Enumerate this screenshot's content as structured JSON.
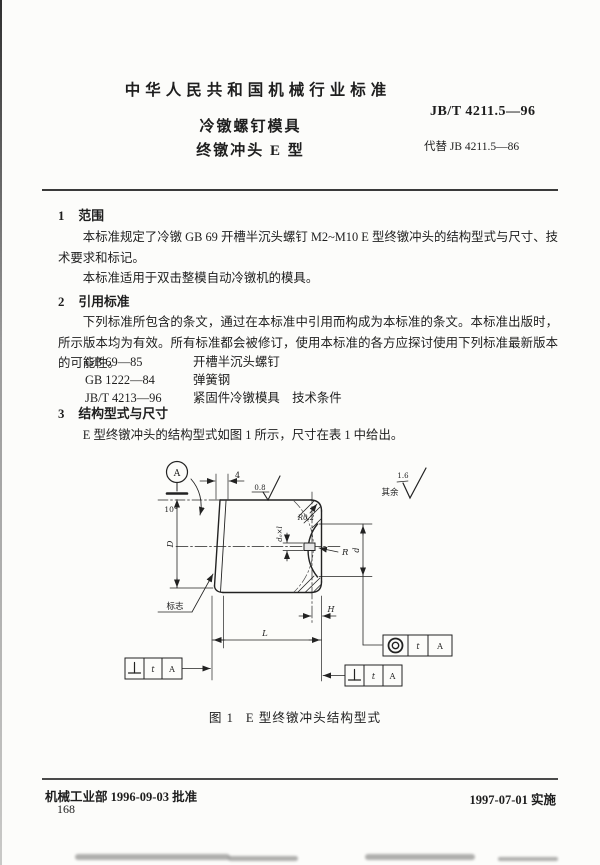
{
  "header": {
    "org_title": "中华人民共和国机械行业标准",
    "doc_title_line1": "冷镦螺钉模具",
    "doc_title_line2": "终镦冲头  E 型",
    "standard_no": "JB/T  4211.5—96",
    "replaces": "代替 JB  4211.5—86"
  },
  "sections": {
    "s1": {
      "no": "1",
      "title": "范围",
      "p1": "本标准规定了冷镦 GB 69 开槽半沉头螺钉 M2~M10 E 型终镦冲头的结构型式与尺寸、技术要求和标记。",
      "p2": "本标准适用于双击整模自动冷镦机的模具。"
    },
    "s2": {
      "no": "2",
      "title": "引用标准",
      "p1": "下列标准所包含的条文，通过在本标准中引用而构成为本标准的条文。本标准出版时，所示版本均为有效。所有标准都会被修订，使用本标准的各方应探讨使用下列标准最新版本的可能性。",
      "refs": [
        {
          "code": "GB 69—85",
          "name": "开槽半沉头螺钉"
        },
        {
          "code": "GB 1222—84",
          "name": "弹簧钢"
        },
        {
          "code": "JB/T 4213—96",
          "name": "紧固件冷镦模具　技术条件"
        }
      ]
    },
    "s3": {
      "no": "3",
      "title": "结构型式与尺寸",
      "p1": "E 型终镦冲头的结构型式如图 1 所示，尺寸在表 1 中给出。"
    }
  },
  "figure": {
    "datum": "A",
    "angle": "10°",
    "taper_len": "4",
    "finish_face": "0.8",
    "rest_label": "其余",
    "rest_value": "1.6",
    "corner_radius": "R0.2",
    "pin_dim": "d₀×l",
    "cavity_radius": "R",
    "dia_outer": "D",
    "dia_cavity": "d",
    "length": "L",
    "depth": "H",
    "mark_label": "标志",
    "tol_t": "t",
    "tol_datum": "A"
  },
  "caption": {
    "fig_no": "图 1",
    "text": "E 型终镦冲头结构型式"
  },
  "footer": {
    "approve": "机械工业部 1996-09-03 批准",
    "implement": "1997-07-01 实施",
    "page_no": "168"
  },
  "colors": {
    "ink": "#1e1e1e",
    "paper": "#fcfcfa"
  }
}
